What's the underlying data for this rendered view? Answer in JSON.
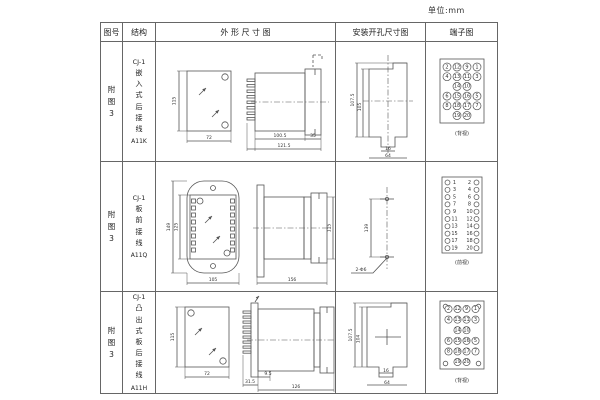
{
  "unit_label": "单位:mm",
  "header": {
    "figure": "图号",
    "structure": "结构",
    "outline": "外 形 尺 寸 图",
    "mounting": "安装开孔尺寸图",
    "terminal": "端子图"
  },
  "rows": [
    {
      "figure": "附图3",
      "model": "CJ-1",
      "desc": "嵌入式后接线",
      "code": "A11K",
      "outline": {
        "h": "115",
        "w": "72",
        "body": "100.5",
        "total": "121.5",
        "flange": "35"
      },
      "mounting": {
        "outer": "107.5",
        "inner": "105",
        "notch": "16",
        "width": "64"
      },
      "terminal": {
        "label": "(背视)",
        "grid": [
          [
            "2",
            "12",
            "9",
            "1"
          ],
          [
            "4",
            "13",
            "11",
            "3"
          ],
          [
            "14",
            "10"
          ],
          [
            "6",
            "15",
            "16",
            "5"
          ],
          [
            "8",
            "18",
            "17",
            "7"
          ],
          [
            "19",
            "20"
          ]
        ]
      }
    },
    {
      "figure": "附图3",
      "model": "CJ-1",
      "desc": "板前接线",
      "code": "A11Q",
      "outline": {
        "outer_h": "149",
        "inner_h": "125",
        "w": "105",
        "len": "156",
        "side_h": "115"
      },
      "mounting": {
        "spacing": "139",
        "holes": "2-Φ6"
      },
      "terminal": {
        "label": "(前视)",
        "left": [
          "1",
          "3",
          "5",
          "7",
          "9",
          "11",
          "13",
          "15",
          "17",
          "19"
        ],
        "right": [
          "2",
          "4",
          "6",
          "8",
          "10",
          "12",
          "14",
          "16",
          "18",
          "20"
        ]
      }
    },
    {
      "figure": "附图3",
      "model": "CJ-1",
      "desc": "凸出式板后接线",
      "code": "A11H",
      "outline": {
        "h": "115",
        "w": "72",
        "plate": "31.5",
        "step": "9.5",
        "len": "126"
      },
      "mounting": {
        "outer": "107.5",
        "inner": "104",
        "notch": "16",
        "width": "64"
      },
      "terminal": {
        "label": "(背视)",
        "grid": [
          [
            "2",
            "12",
            "9",
            "1"
          ],
          [
            "4",
            "13",
            "11",
            "3"
          ],
          [
            "14",
            "10"
          ],
          [
            "6",
            "15",
            "16",
            "5"
          ],
          [
            "8",
            "18",
            "17",
            "7"
          ],
          [
            "19",
            "20"
          ]
        ]
      }
    }
  ]
}
